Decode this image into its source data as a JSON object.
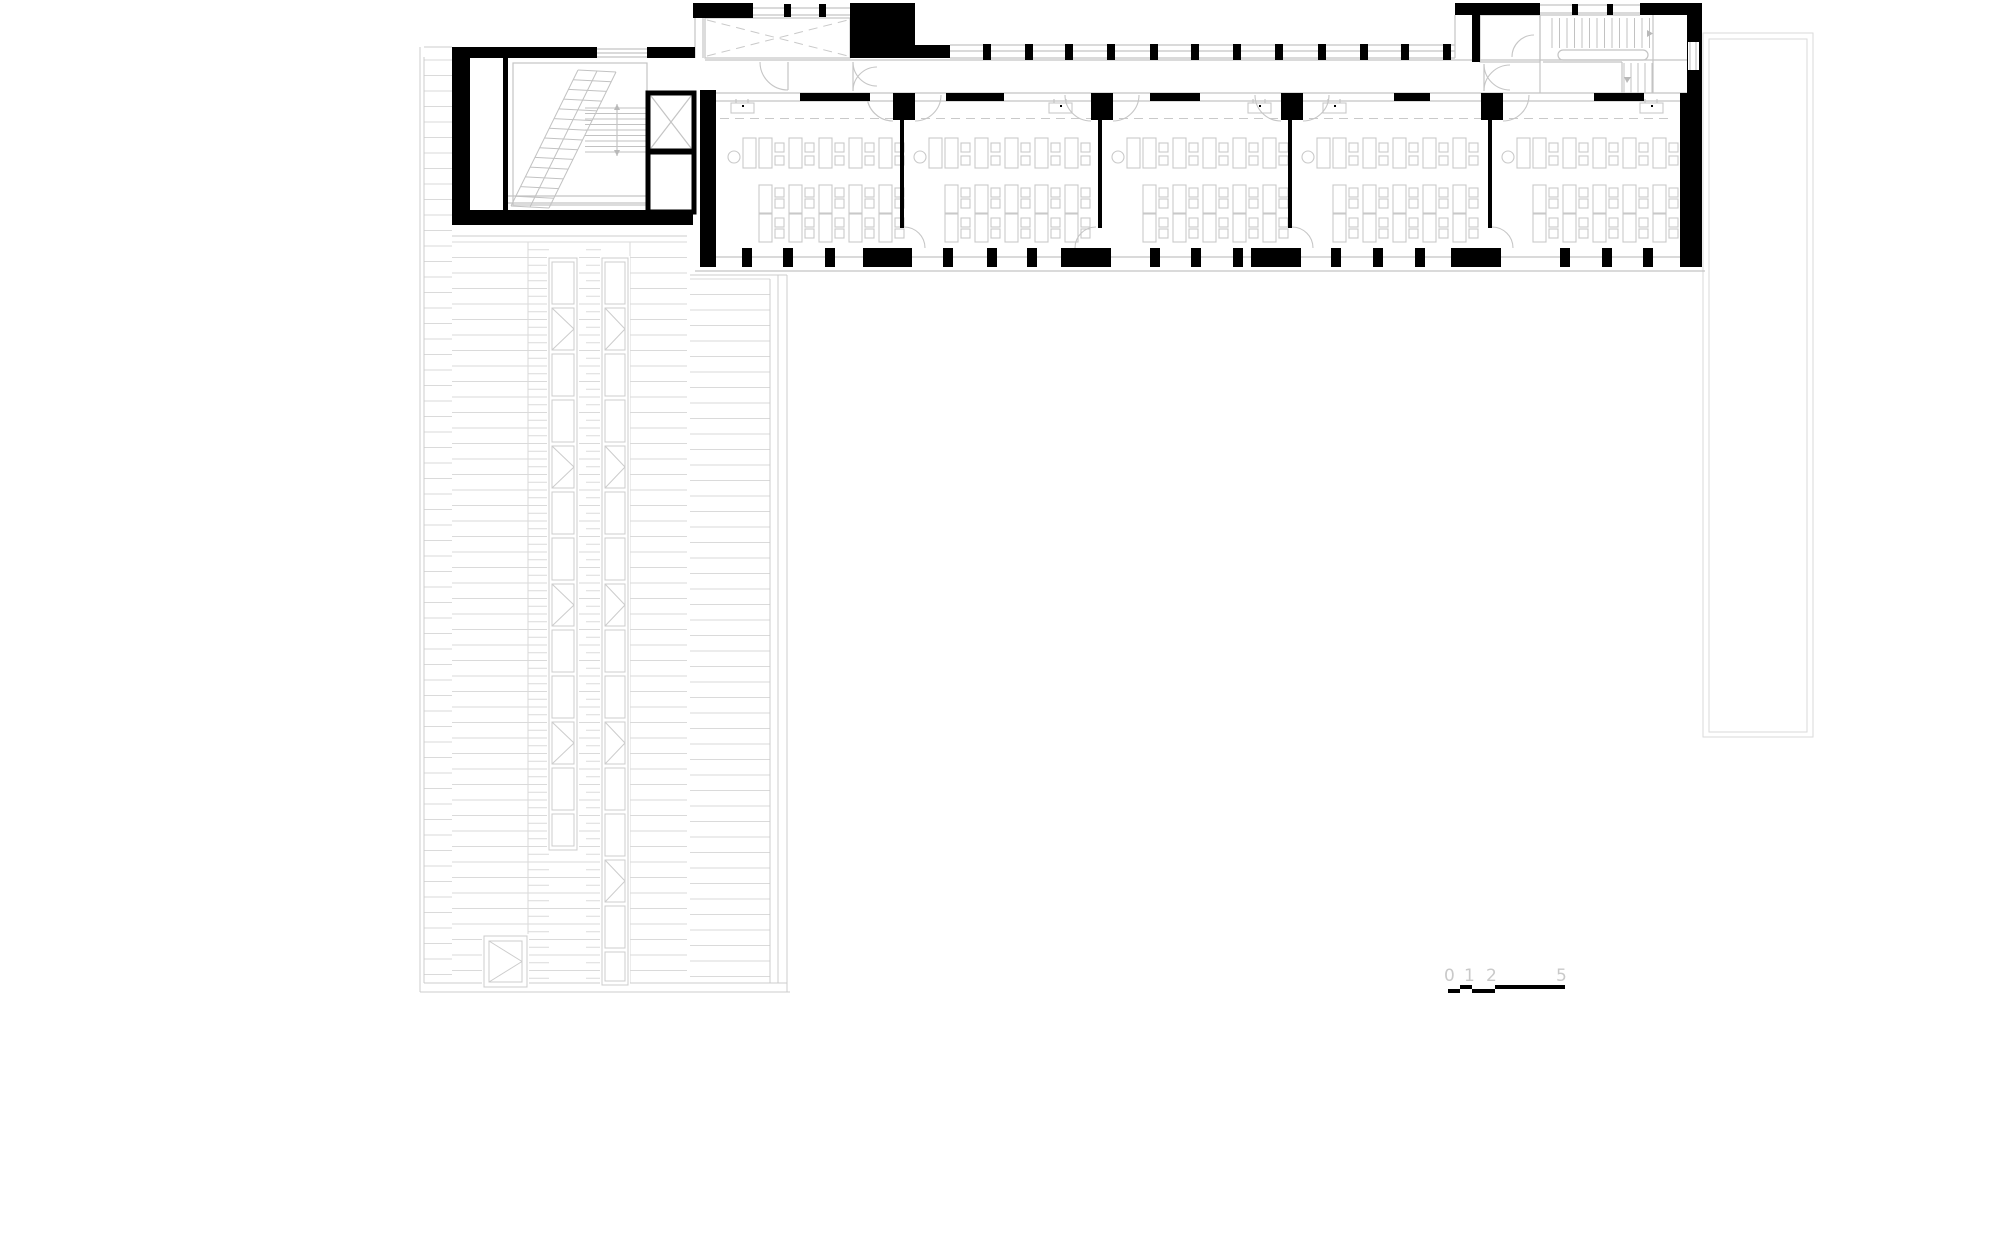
{
  "title": "building-floor-plan",
  "colors": {
    "ink": "#000000",
    "line": "#c4c4c4",
    "faint": "#dadada",
    "label": "#c9c9c9"
  },
  "scale_bar": {
    "labels": [
      {
        "t": "0",
        "x": 1447
      },
      {
        "t": "1",
        "x": 1467
      },
      {
        "t": "2",
        "x": 1489
      },
      {
        "t": "5",
        "x": 1559
      }
    ],
    "segments": [
      [
        1448,
        989,
        12,
        4
      ],
      [
        1472,
        989,
        23,
        4
      ],
      [
        1460,
        985,
        12,
        4
      ],
      [
        1495,
        985,
        70,
        4
      ]
    ]
  },
  "plan": {
    "blacks": [
      [
        452,
        47,
        145,
        11
      ],
      [
        647,
        47,
        48,
        11
      ],
      [
        452,
        58,
        18,
        167
      ],
      [
        452,
        210,
        241,
        15
      ],
      [
        503,
        58,
        5,
        152
      ],
      [
        693,
        3,
        60,
        15
      ],
      [
        784,
        4,
        7,
        13
      ],
      [
        819,
        4,
        7,
        13
      ],
      [
        850,
        3,
        65,
        55
      ],
      [
        915,
        45,
        35,
        13
      ],
      [
        1455,
        3,
        85,
        12
      ],
      [
        1572,
        4,
        6,
        11
      ],
      [
        1607,
        4,
        6,
        11
      ],
      [
        1640,
        3,
        62,
        12
      ],
      [
        1687,
        3,
        15,
        264
      ],
      [
        1472,
        15,
        8,
        47
      ],
      [
        700,
        90,
        16,
        177
      ],
      [
        1680,
        93,
        22,
        174
      ],
      [
        893,
        93,
        22,
        27
      ],
      [
        1091,
        93,
        22,
        27
      ],
      [
        1281,
        93,
        22,
        27
      ],
      [
        1481,
        93,
        22,
        27
      ],
      [
        800,
        93,
        70,
        8
      ],
      [
        946,
        93,
        58,
        8
      ],
      [
        1150,
        93,
        50,
        8
      ],
      [
        1394,
        93,
        36,
        8
      ],
      [
        1594,
        93,
        50,
        8
      ],
      [
        863,
        248,
        49,
        19
      ],
      [
        1061,
        248,
        50,
        19
      ],
      [
        1251,
        248,
        50,
        19
      ],
      [
        1451,
        248,
        50,
        19
      ]
    ],
    "north_piers_x": [
      983,
      1025,
      1065,
      1107,
      1150,
      1191,
      1233,
      1275,
      1318,
      1360,
      1401,
      1443
    ],
    "glines": [
      [
        597,
        49,
        647,
        49
      ],
      [
        597,
        53,
        647,
        53
      ],
      [
        597,
        57,
        647,
        57
      ],
      [
        753,
        8,
        850,
        8
      ],
      [
        753,
        15,
        850,
        15
      ],
      [
        695,
        18,
        695,
        58
      ],
      [
        703,
        18,
        703,
        58
      ],
      [
        950,
        45,
        1455,
        45
      ],
      [
        950,
        51,
        1455,
        51
      ],
      [
        950,
        58,
        1455,
        58
      ],
      [
        1455,
        15,
        1455,
        58
      ],
      [
        705,
        60,
        1687,
        60
      ],
      [
        705,
        93,
        1687,
        93
      ],
      [
        716,
        101,
        1680,
        101
      ],
      [
        716,
        257,
        1680,
        257
      ],
      [
        695,
        271,
        1705,
        271
      ],
      [
        1540,
        5,
        1640,
        5
      ],
      [
        1540,
        13,
        1640,
        13
      ],
      [
        1540,
        15,
        1640,
        15
      ],
      [
        1540,
        15,
        1540,
        93
      ],
      [
        1653,
        15,
        1653,
        93
      ],
      [
        1543,
        62,
        1622,
        62
      ],
      [
        1622,
        62,
        1622,
        93
      ],
      [
        1690,
        42,
        1690,
        70
      ],
      [
        1696,
        42,
        1696,
        70
      ],
      [
        508,
        196,
        652,
        196
      ],
      [
        508,
        203,
        652,
        203
      ],
      [
        788,
        62,
        788,
        90
      ],
      [
        853,
        62,
        853,
        91
      ],
      [
        1484,
        64,
        1484,
        91
      ]
    ],
    "grects": [
      [
        705,
        18,
        145,
        40
      ],
      [
        513,
        63,
        134,
        142
      ],
      [
        1480,
        15,
        60,
        47
      ]
    ],
    "white_rects": [
      [
        1688,
        42,
        11,
        28
      ]
    ],
    "terrace": {
      "outer": [
        1703,
        33,
        110,
        704
      ],
      "inner": [
        1709,
        39,
        98,
        693
      ]
    },
    "vest_dash": [
      [
        707,
        20,
        848,
        56
      ],
      [
        707,
        56,
        848,
        20
      ]
    ],
    "elevator": {
      "upper": [
        648,
        93,
        46,
        58
      ],
      "lower": [
        648,
        152,
        46,
        60
      ],
      "xlines": [
        [
          651,
          96,
          691,
          148
        ],
        [
          691,
          96,
          651,
          148
        ]
      ]
    },
    "arcs": [
      "M 760 62 A 28 28 0 0 0 788 90",
      "M 853 62 A 24 24 0 0 0 877 86",
      "M 853 91 A 24 24 0 0 1 877 67",
      "M 1484 64 A 26 26 0 0 0 1510 90",
      "M 1484 91 A 26 26 0 0 1 1510 65",
      "M 1512 57 A 22 22 0 0 1 1534 35",
      "M 867 95 A 26 26 0 0 0 893 121",
      "M 1529 95 A 26 26 0 0 1 1503 121",
      "M 904 227 A 21 21 0 0 1 925 248",
      "M 1096 227 A 21 21 0 0 0 1075 248",
      "M 1292 227 A 21 21 0 0 1 1313 248",
      "M 1492 227 A 21 21 0 0 1 1513 248"
    ],
    "rooms": {
      "boundaries": [
        716,
        902,
        1100,
        1290,
        1490,
        1680
      ],
      "partitions": [
        902,
        1100,
        1290
      ],
      "partition_walls": [
        902,
        1100,
        1290,
        1490
      ],
      "dash_y": 118.5,
      "teacher": {
        "circle_dx": 18,
        "circle_cy": 157,
        "r": 6,
        "desk_dx": 27
      },
      "cols": {
        "start_dx": 43,
        "pitch": 30,
        "table_w": 13,
        "upper_y": 138,
        "upper_h": 30,
        "lower_y1": 185,
        "lower_y2": 214,
        "lower_h": 28,
        "chair_dx": 16,
        "chair": 9,
        "upper_chair_ys": [
          143,
          156
        ],
        "lower_chair_ys": [
          188,
          199,
          218,
          229
        ]
      },
      "sinks_x": [
        731,
        1049,
        1248,
        1323,
        1640
      ],
      "south_piers_dx": [
        [
          26,
          67,
          109
        ],
        [
          41,
          85,
          125
        ],
        [
          50,
          91,
          133
        ],
        [
          41,
          83,
          125
        ],
        [
          70,
          112,
          153
        ]
      ]
    },
    "left_stair": {
      "stringers": [
        [
          511,
          206,
          578,
          70
        ],
        [
          530,
          207,
          597,
          71
        ],
        [
          549,
          208,
          616,
          72
        ]
      ],
      "tread_count": 14,
      "return_treads": {
        "x1": 585,
        "x2": 648,
        "y1": 108,
        "y2": 152,
        "step": 5.5
      },
      "rail": [
        617,
        104,
        617,
        156
      ],
      "arrows": [
        [
          [
            614,
            110
          ],
          [
            620,
            110
          ],
          [
            617,
            104
          ]
        ],
        [
          [
            614,
            150
          ],
          [
            620,
            150
          ],
          [
            617,
            156
          ]
        ]
      ]
    },
    "right_stair": {
      "upper_treads": {
        "y1": 18,
        "y2": 48,
        "x1": 1552,
        "x2": 1650,
        "step": 7.5
      },
      "lower_treads": {
        "x1": 1624,
        "x2": 1652,
        "y1": 63,
        "y2": 93,
        "step": 7
      },
      "rail": [
        1558,
        50,
        90,
        10
      ],
      "arrows": [
        [
          [
            1647,
            30
          ],
          [
            1647,
            37
          ],
          [
            1653,
            33.5
          ]
        ],
        [
          [
            1624,
            77
          ],
          [
            1631,
            77
          ],
          [
            1627,
            83
          ]
        ]
      ]
    },
    "deck": {
      "regions": [
        {
          "x1": 424,
          "x2": 452,
          "y1": 60,
          "y2": 983
        },
        {
          "x1": 452,
          "x2": 687,
          "y1": 242,
          "y2": 983
        },
        {
          "x1": 690,
          "x2": 770,
          "y1": 279,
          "y2": 983
        }
      ],
      "pitch": 15.5,
      "dense": [
        [
          528,
          549
        ],
        [
          586,
          601
        ]
      ],
      "joints": [
        528,
        630
      ],
      "borders": [
        [
          420,
          47,
          420,
          992
        ],
        [
          424,
          57,
          424,
          983
        ],
        [
          420,
          992,
          790,
          992
        ],
        [
          424,
          983,
          787,
          983
        ],
        [
          770,
          279,
          770,
          983
        ],
        [
          778,
          275,
          778,
          983
        ],
        [
          787,
          275,
          787,
          992
        ],
        [
          690,
          275,
          787,
          275
        ],
        [
          452,
          236,
          687,
          236
        ],
        [
          424,
          47,
          452,
          47
        ]
      ],
      "stripA": {
        "x": 549,
        "w": 28,
        "y1": 262,
        "y2": 848
      },
      "stripB": {
        "x": 602,
        "w": 26,
        "y1": 262,
        "y2": 983
      },
      "panel_step": 46,
      "panel_h": 42,
      "hatch": [
        484,
        936,
        43,
        51
      ]
    }
  }
}
